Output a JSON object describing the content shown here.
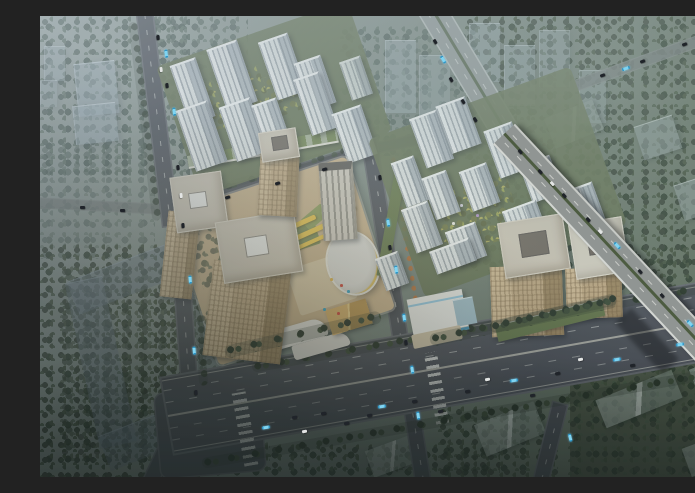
{
  "scene": {
    "title": "Aerial rendering of a mixed-use development at dusk",
    "description": "Bird's-eye architectural rendering: a commercial office plaza with tan towers and an oval retail building on the left, two white residential high-rise clusters with landscaped courtyards in the center and right, bounded by tree-lined avenues, a wide multi-lane boulevard across the bottom and an elevated highway crossing it on the right; hazy faded cityscape, ghost buildings and dark woodland fill the surroundings.",
    "time_of_day": "dusk haze",
    "districts": {
      "left": "office and retail plaza with three tan towers, striped slab tower, oval atrium building, gold pavilion and terracotta plaza",
      "top_center": "white residential towers with green courtyards and a green-roofed retail strip",
      "right": "white residential towers around an olive garden, two tan towers under warm light, white sales pavilion with blue trim",
      "background": "faded ghost towers, gabled low-rise blocks, dense dark tree cover, dark courtyard building at lower left"
    },
    "palette": {
      "haze": "#bcc6cc",
      "ground_sage": "#8b968e",
      "ground_dark": "#2e352f",
      "trees_dark": "#2c3627",
      "trees_teal": "#556658",
      "trees_olive": "#9aa04e",
      "road": "#45474d",
      "boulevard": "#474950",
      "highway": "#909593",
      "lane_marking": "#ebebe4",
      "tower_white": "#e6e9e7",
      "tower_shadow_face": "#8d969c",
      "tower_tan": "#c3a87f",
      "roof_tan": "#cfc5b3",
      "helipad": "#f4f2ec",
      "plaza_terracotta": "#c8ae84",
      "lawn": "#76854c",
      "stall_yellow": "#ecc23e",
      "oval_gold_ring": "#d9b752",
      "sales_blue": "#49a8d8",
      "bus_cyan": "#3db4e4",
      "car_dark": "#20242a"
    },
    "counts": {
      "white_residential_towers": 23,
      "tan_towers": 5,
      "ghost_buildings": 14,
      "major_roads": 6
    },
    "vehicles": [
      {
        "t": "bus",
        "x": 222,
        "y": 410,
        "r": -10
      },
      {
        "t": "bus",
        "x": 338,
        "y": 389,
        "r": -10
      },
      {
        "t": "bus",
        "x": 470,
        "y": 363,
        "r": -10
      },
      {
        "t": "bus",
        "x": 573,
        "y": 342,
        "r": -10
      },
      {
        "t": "bus",
        "x": 636,
        "y": 327,
        "r": -10
      },
      {
        "t": "car",
        "x": 252,
        "y": 400,
        "r": -10
      },
      {
        "t": "car",
        "x": 281,
        "y": 396,
        "r": -10
      },
      {
        "t": "car",
        "x": 304,
        "y": 406,
        "r": -10
      },
      {
        "t": "car",
        "x": 327,
        "y": 398,
        "r": -10
      },
      {
        "t": "car",
        "x": 372,
        "y": 384,
        "r": -10
      },
      {
        "t": "car",
        "x": 398,
        "y": 394,
        "r": -10
      },
      {
        "t": "car",
        "x": 425,
        "y": 374,
        "r": -10
      },
      {
        "t": "car",
        "x": 490,
        "y": 378,
        "r": -10
      },
      {
        "t": "car",
        "x": 515,
        "y": 356,
        "r": -10
      },
      {
        "t": "car",
        "x": 590,
        "y": 348,
        "r": -10
      },
      {
        "t": "car",
        "x": 660,
        "y": 316,
        "r": -10
      },
      {
        "t": "carw",
        "x": 262,
        "y": 414,
        "r": -10
      },
      {
        "t": "carw",
        "x": 445,
        "y": 362,
        "r": -10
      },
      {
        "t": "carw",
        "x": 538,
        "y": 342,
        "r": -10
      },
      {
        "t": "bus",
        "x": 122,
        "y": 36,
        "r": 83
      },
      {
        "t": "bus",
        "x": 130,
        "y": 94,
        "r": 83
      },
      {
        "t": "bus",
        "x": 146,
        "y": 262,
        "r": 85
      },
      {
        "t": "bus",
        "x": 150,
        "y": 333,
        "r": 85
      },
      {
        "t": "car",
        "x": 116,
        "y": 20,
        "r": 83
      },
      {
        "t": "car",
        "x": 125,
        "y": 68,
        "r": 83
      },
      {
        "t": "car",
        "x": 136,
        "y": 150,
        "r": 84
      },
      {
        "t": "car",
        "x": 141,
        "y": 208,
        "r": 85
      },
      {
        "t": "car",
        "x": 154,
        "y": 375,
        "r": 85
      },
      {
        "t": "carw",
        "x": 119,
        "y": 52,
        "r": 83
      },
      {
        "t": "carw",
        "x": 139,
        "y": 178,
        "r": 84
      },
      {
        "t": "bus",
        "x": 399,
        "y": 42,
        "r": 59
      },
      {
        "t": "car",
        "x": 393,
        "y": 24,
        "r": 59
      },
      {
        "t": "car",
        "x": 409,
        "y": 62,
        "r": 59
      },
      {
        "t": "car",
        "x": 421,
        "y": 84,
        "r": 59
      },
      {
        "t": "car",
        "x": 433,
        "y": 102,
        "r": 57
      },
      {
        "t": "bus",
        "x": 573,
        "y": 228,
        "r": 47
      },
      {
        "t": "bus",
        "x": 646,
        "y": 306,
        "r": 47
      },
      {
        "t": "car",
        "x": 478,
        "y": 134,
        "r": 48
      },
      {
        "t": "car",
        "x": 498,
        "y": 154,
        "r": 47
      },
      {
        "t": "car",
        "x": 522,
        "y": 178,
        "r": 47
      },
      {
        "t": "car",
        "x": 546,
        "y": 202,
        "r": 47
      },
      {
        "t": "car",
        "x": 598,
        "y": 254,
        "r": 47
      },
      {
        "t": "car",
        "x": 620,
        "y": 278,
        "r": 47
      },
      {
        "t": "car",
        "x": 666,
        "y": 328,
        "r": 47
      },
      {
        "t": "car",
        "x": 686,
        "y": 340,
        "r": 47
      },
      {
        "t": "carw",
        "x": 510,
        "y": 166,
        "r": 47
      },
      {
        "t": "carw",
        "x": 558,
        "y": 214,
        "r": 47
      },
      {
        "t": "bus",
        "x": 344,
        "y": 205,
        "r": 81
      },
      {
        "t": "bus",
        "x": 352,
        "y": 252,
        "r": 81
      },
      {
        "t": "bus",
        "x": 360,
        "y": 300,
        "r": 81
      },
      {
        "t": "bus",
        "x": 368,
        "y": 352,
        "r": 81
      },
      {
        "t": "bus",
        "x": 374,
        "y": 398,
        "r": 81
      },
      {
        "t": "car",
        "x": 338,
        "y": 160,
        "r": 81
      },
      {
        "t": "car",
        "x": 348,
        "y": 230,
        "r": 81
      },
      {
        "t": "car",
        "x": 364,
        "y": 325,
        "r": 81
      },
      {
        "t": "car",
        "x": 185,
        "y": 180,
        "r": -17
      },
      {
        "t": "car",
        "x": 235,
        "y": 166,
        "r": -17
      },
      {
        "t": "car",
        "x": 282,
        "y": 152,
        "r": -17
      },
      {
        "t": "car",
        "x": 560,
        "y": 58,
        "r": -20
      },
      {
        "t": "car",
        "x": 600,
        "y": 44,
        "r": -20
      },
      {
        "t": "car",
        "x": 642,
        "y": 27,
        "r": -20
      },
      {
        "t": "bus",
        "x": 582,
        "y": 51,
        "r": -20
      },
      {
        "t": "bus",
        "x": 526,
        "y": 420,
        "r": 76
      },
      {
        "t": "car",
        "x": 40,
        "y": 190,
        "r": 2
      },
      {
        "t": "car",
        "x": 80,
        "y": 193,
        "r": 2
      }
    ]
  }
}
